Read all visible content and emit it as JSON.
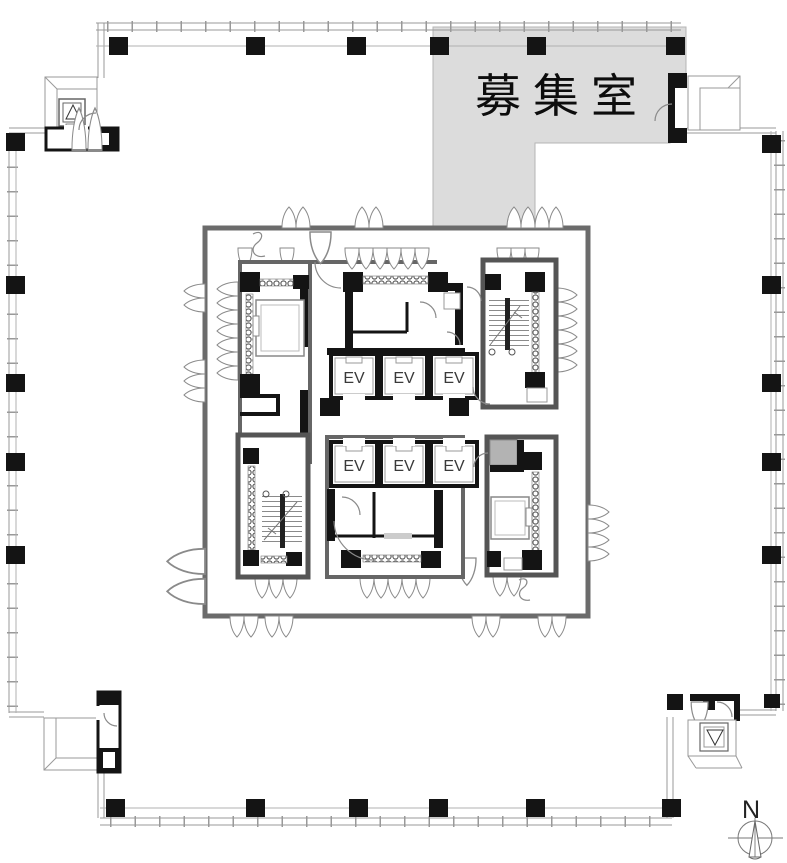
{
  "floor_plan": {
    "vacancy_label": "募集室",
    "north_label": "N",
    "elevators": {
      "upper_bank": [
        "EV",
        "EV",
        "EV"
      ],
      "lower_bank": [
        "EV",
        "EV",
        "EV"
      ]
    },
    "colors": {
      "vacancy_fill": "#dcdcdc",
      "highlight_fill": "#b3b3b3",
      "wall_black": "#141414",
      "core_border": "#666666",
      "outline_gray": "#999999"
    }
  }
}
